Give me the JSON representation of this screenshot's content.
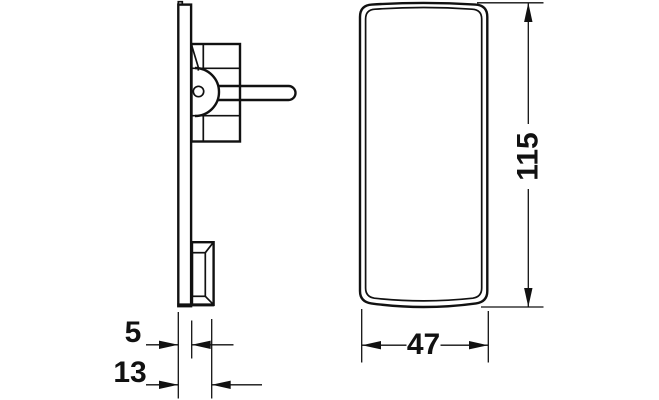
{
  "drawing": {
    "background_color": "#ffffff",
    "line_color": "#111111",
    "views": {
      "side_view": "side-profile-of-back-plate-with-clip",
      "front_view": "front-face-of-cover-cap"
    },
    "dimensions": {
      "plate_thickness": {
        "label": "5",
        "value": 5
      },
      "overall_depth": {
        "label": "13",
        "value": 13
      },
      "cap_width": {
        "label": "47",
        "value": 47
      },
      "cap_height": {
        "label": "115",
        "value": 115
      }
    }
  }
}
